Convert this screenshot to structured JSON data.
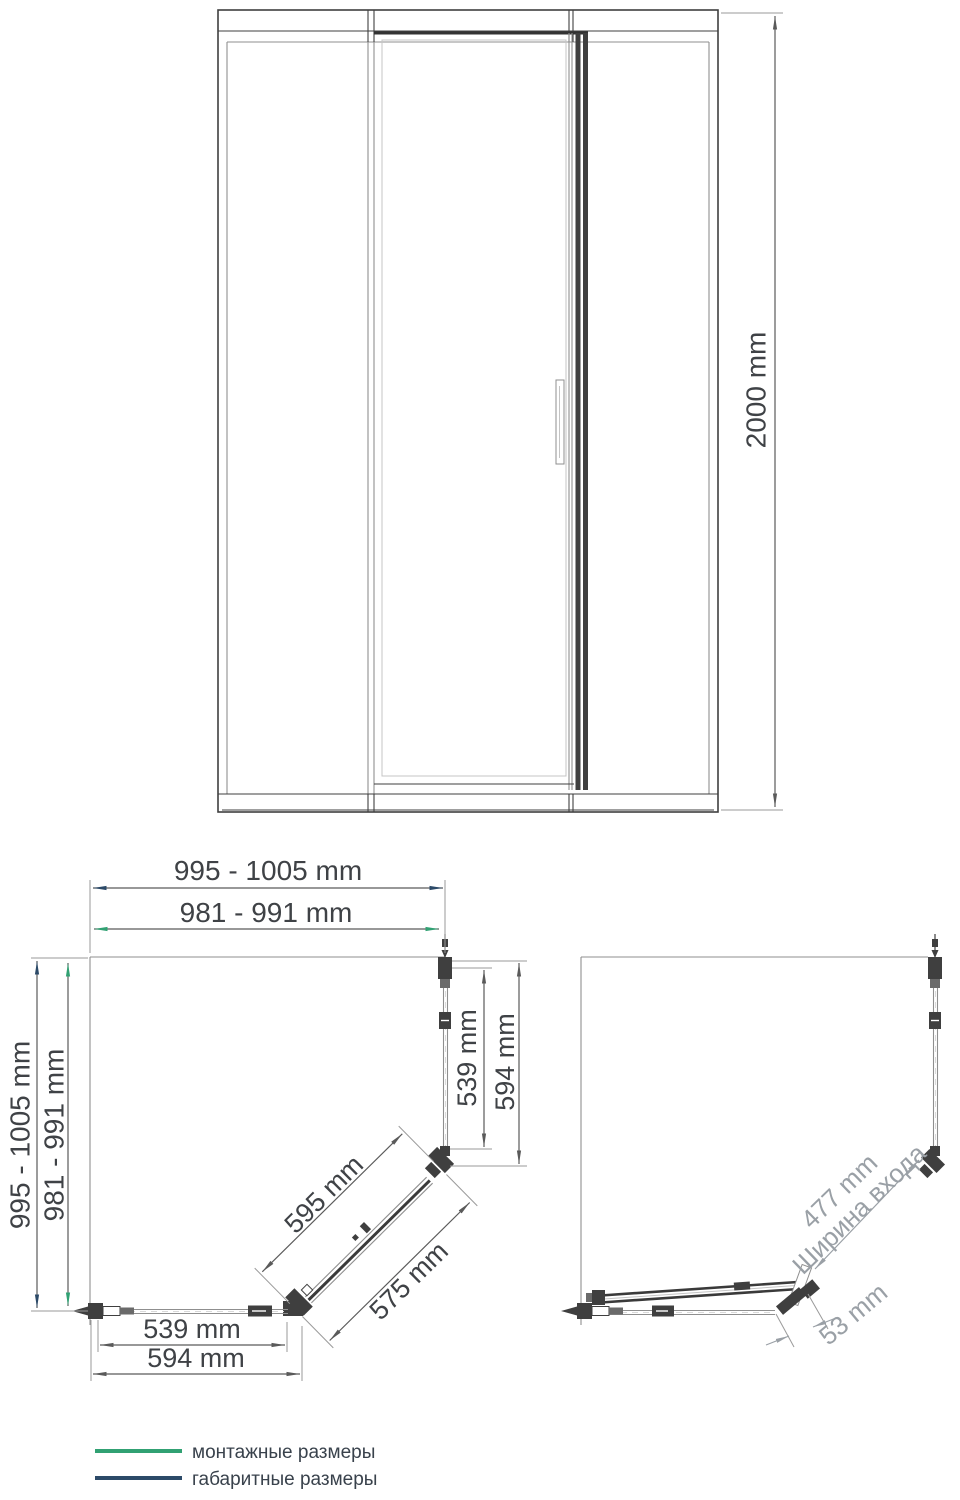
{
  "colors": {
    "outline": "#3f3f3f",
    "light_line": "#8f8f8f",
    "dim_line": "#5a5a5a",
    "dim_text": "#3f4246",
    "mounting_green": "#31a173",
    "overall_navy": "#2c4a68",
    "gray_label": "#9aa0a6"
  },
  "elevation": {
    "height": "2000 mm"
  },
  "plan_closed": {
    "width_overall": "995 - 1005 mm",
    "width_mounting": "981 - 991 mm",
    "depth_overall": "995 - 1005 mm",
    "depth_mounting": "981 - 991 mm",
    "side_panel_glass": "539 mm",
    "side_panel_overall": "594 mm",
    "door_glass": "595 mm",
    "door_overall": "575 mm",
    "bottom_panel_glass": "539 mm",
    "bottom_panel_overall": "594 mm"
  },
  "plan_open": {
    "entrance_width": "477 mm",
    "entrance_label": "Ширина входа",
    "pivot_offset": "53 mm"
  },
  "legend": {
    "items": [
      {
        "label": "монтажные размеры",
        "color": "#31a173"
      },
      {
        "label": "габаритные размеры",
        "color": "#2c4a68"
      }
    ]
  }
}
